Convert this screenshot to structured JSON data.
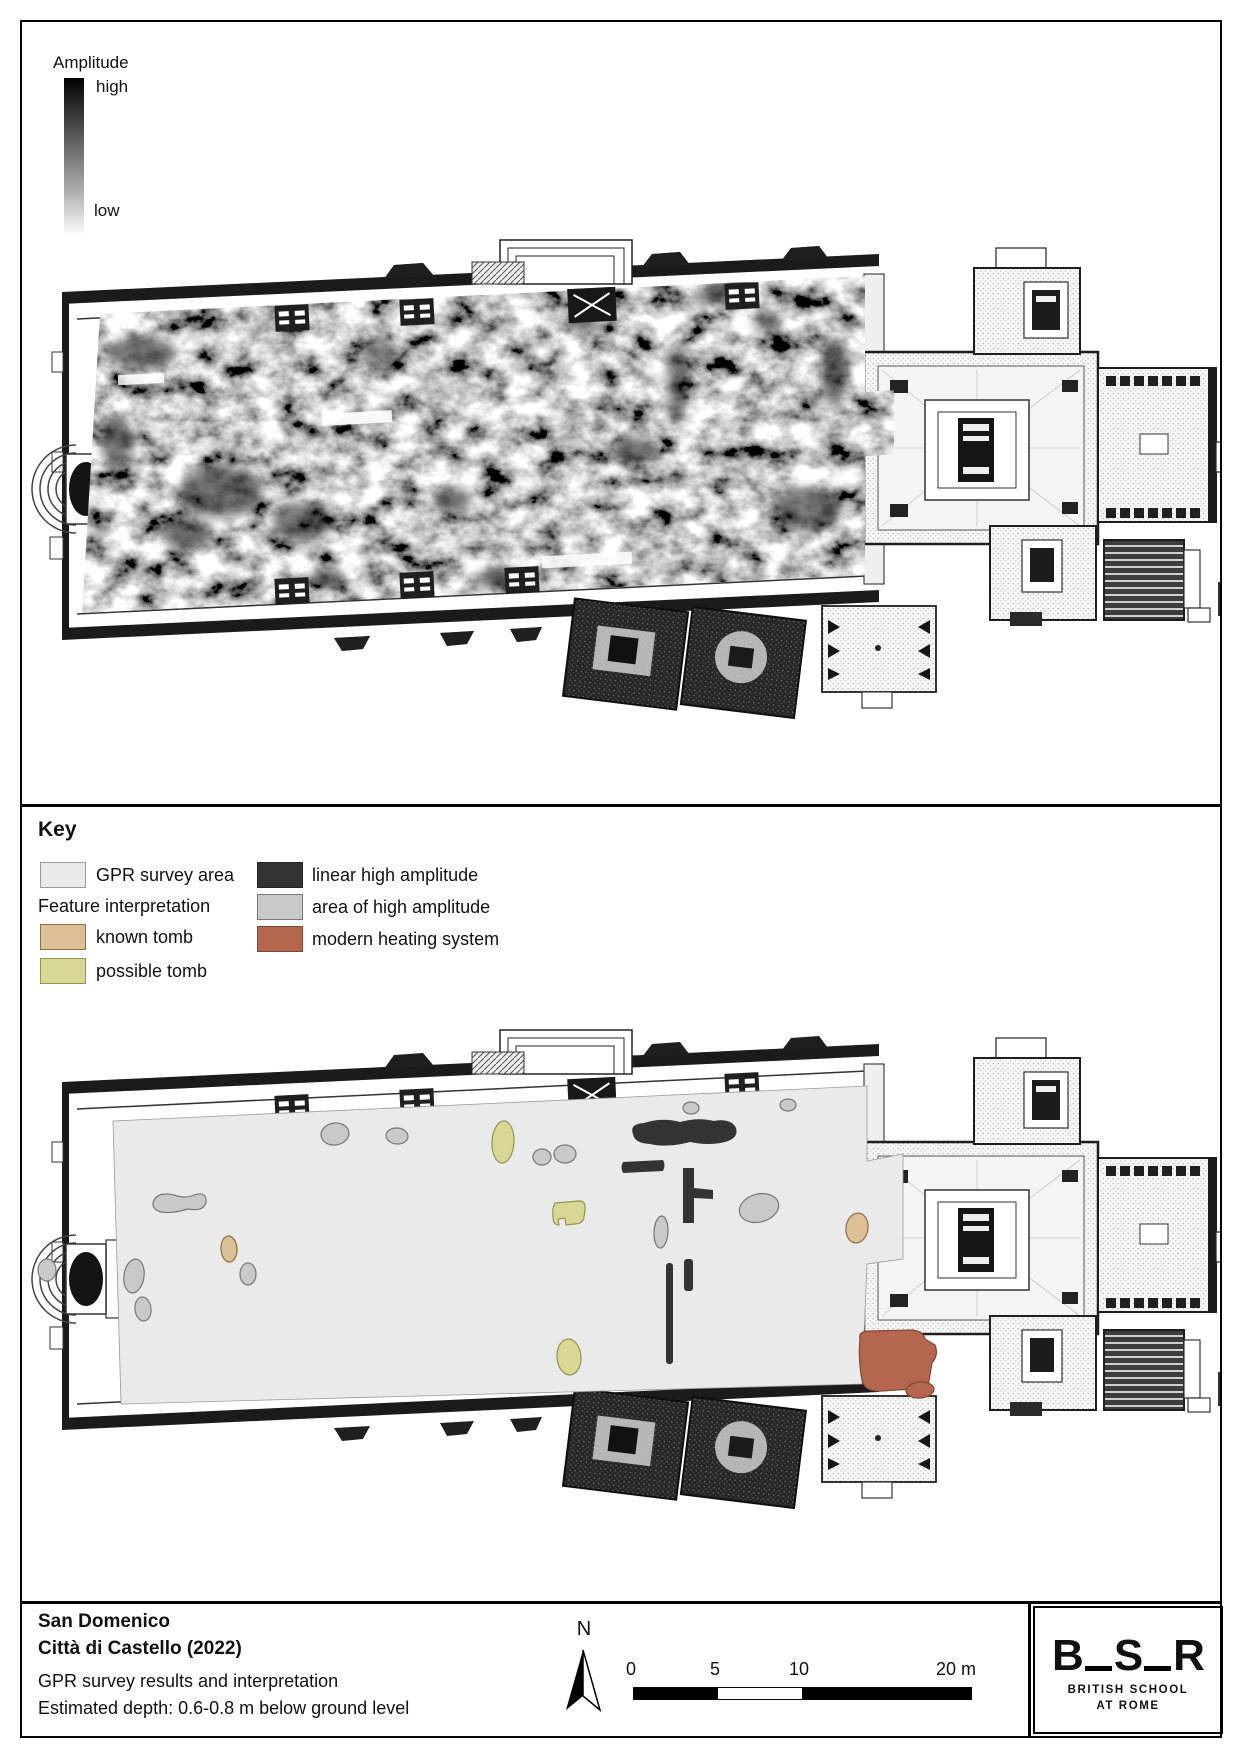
{
  "amplitude_legend": {
    "title": "Amplitude",
    "high_label": "high",
    "low_label": "low"
  },
  "key": {
    "heading": "Key",
    "survey_item": {
      "label": "GPR survey area"
    },
    "feature_heading": "Feature interpretation",
    "known_tomb": {
      "label": "known tomb"
    },
    "possible_tomb": {
      "label": "possible tomb"
    },
    "linear": {
      "label": "linear high amplitude"
    },
    "area": {
      "label": "area of high amplitude"
    },
    "heating": {
      "label": "modern heating system"
    }
  },
  "title_block": {
    "line1": "San Domenico",
    "line2": "Città di Castello (2022)",
    "line3": "GPR survey results and interpretation",
    "line4": "Estimated depth: 0.6-0.8 m below ground level"
  },
  "north_label": "N",
  "scale_bar": {
    "tick0": "0",
    "tick5": "5",
    "tick10": "10",
    "end": "20 m"
  },
  "logo": {
    "b": "B",
    "s": "S",
    "r": "R",
    "school": "BRITISH SCHOOL",
    "at": "AT ROME"
  },
  "colors": {
    "survey": "#eaeaea",
    "survey_border": "#9a9a9a",
    "area": "#c9c9c9",
    "area_border": "#777777",
    "tomb_known": "#ddc096",
    "tomb_known_border": "#8d6f45",
    "tomb_possible": "#d9d795",
    "tomb_possible_border": "#94944e",
    "linear": "#333333",
    "heating": "#b4674e",
    "heating_border": "#7e4836"
  },
  "map": {
    "survey_outline": "M91,309 L845,274 L845,349 L881,342 L881,447 L845,452 L840,572 L99,592 Z",
    "features": [
      {
        "k": "area",
        "e": [
          313,
          322,
          14,
          11,
          -8
        ]
      },
      {
        "k": "area",
        "e": [
          375,
          324,
          11,
          8,
          5
        ]
      },
      {
        "k": "area",
        "e": [
          520,
          345,
          9,
          8,
          0
        ]
      },
      {
        "k": "area",
        "e": [
          543,
          342,
          11,
          9,
          0
        ]
      },
      {
        "k": "area",
        "e": [
          669,
          296,
          8,
          6,
          0
        ]
      },
      {
        "k": "area",
        "e": [
          766,
          293,
          8,
          6,
          0
        ]
      },
      {
        "k": "area",
        "e": [
          737,
          396,
          20,
          14,
          -15
        ]
      },
      {
        "k": "area",
        "path": "M131,391 Q134,379 152,383 Q163,387 172,383 Q185,379 184,390 Q182,400 166,397 Q149,402 139,400 Q130,397 131,391 Z"
      },
      {
        "k": "area",
        "e": [
          112,
          464,
          10,
          17,
          8
        ]
      },
      {
        "k": "area",
        "e": [
          121,
          497,
          8,
          12,
          -6
        ]
      },
      {
        "k": "area",
        "e": [
          25,
          458,
          9,
          11,
          0
        ]
      },
      {
        "k": "area",
        "e": [
          226,
          462,
          8,
          11,
          0
        ]
      },
      {
        "k": "area",
        "e": [
          639,
          420,
          7,
          16,
          3
        ]
      },
      {
        "k": "tomb_possible",
        "e": [
          481,
          330,
          11,
          21,
          3
        ]
      },
      {
        "k": "tomb_possible",
        "path": "M533,391 L557,389 Q564,389 563,397 L562,405 Q561,412 552,412 L544,413 L543,406 L536,407 L537,413 Q531,413 531,405 Q530,396 533,391 Z"
      },
      {
        "k": "tomb_possible",
        "e": [
          547,
          545,
          12,
          18,
          -4
        ]
      },
      {
        "k": "tomb_known",
        "e": [
          835,
          416,
          11,
          15,
          8
        ]
      },
      {
        "k": "tomb_known",
        "e": [
          207,
          437,
          8,
          13,
          -3
        ]
      },
      {
        "k": "linear",
        "path": "M611,322 Q607,312 622,311 Q640,305 658,310 Q676,305 692,309 Q709,306 714,316 Q717,326 703,330 Q687,334 668,330 Q646,336 628,332 Q612,331 611,322 Z"
      },
      {
        "k": "linear",
        "path": "M601,350 L641,348 Q644,353 641,359 L601,361 Q598,355 601,350 Z"
      },
      {
        "k": "linear",
        "path": "M661,356 L672,356 L672,376 L691,378 L691,387 L672,386 L672,411 L661,411 Z"
      },
      {
        "k": "linear",
        "r": [
          644,
          451,
          7,
          101,
          3
        ]
      },
      {
        "k": "linear",
        "r": [
          662,
          447,
          9,
          32,
          3
        ]
      },
      {
        "k": "heating",
        "path": "M838,527 Q836,519 848,519 L890,518 Q901,519 903,527 L913,533 Q917,543 910,551 L907,569 Q905,578 892,577 L860,579 Q842,580 840,568 Q836,547 838,527 Z"
      },
      {
        "k": "heating",
        "e": [
          898,
          578,
          14,
          8,
          -5
        ]
      }
    ],
    "gpr_anomalies": [
      [
        200,
        470,
        42,
        26
      ],
      [
        280,
        500,
        30,
        20
      ],
      [
        165,
        512,
        25,
        16
      ],
      [
        120,
        330,
        34,
        16
      ],
      [
        360,
        332,
        18,
        12
      ],
      [
        430,
        478,
        20,
        13
      ],
      [
        560,
        300,
        16,
        10
      ],
      [
        612,
        428,
        22,
        14
      ],
      [
        812,
        350,
        13,
        36
      ],
      [
        786,
        487,
        34,
        21
      ],
      [
        700,
        272,
        28,
        11
      ],
      [
        745,
        300,
        14,
        9
      ],
      [
        480,
        556,
        24,
        11
      ],
      [
        305,
        556,
        18,
        9
      ],
      [
        95,
        420,
        16,
        28
      ],
      [
        655,
        360,
        10,
        40
      ]
    ]
  }
}
